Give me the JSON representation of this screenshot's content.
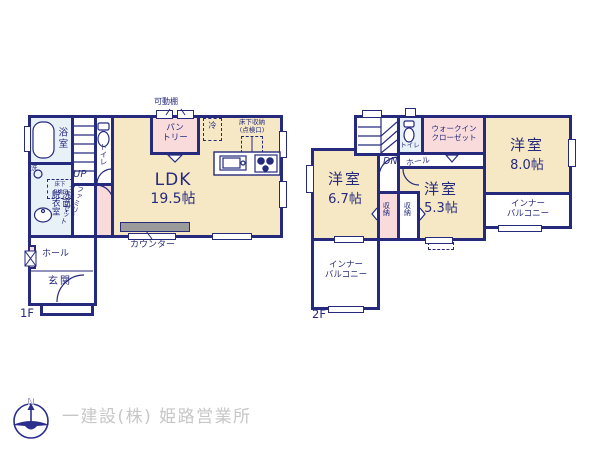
{
  "colors": {
    "wall_navy": "#252a7d",
    "room_cream": "#f6e8c4",
    "room_pink": "#f8dbda",
    "wet_area_blue": "#e9f1f8",
    "counter_gray": "#9b9b9b",
    "footer_text_gray": "#c7c7c7"
  },
  "floor1": {
    "label": "1F",
    "bath": "浴室",
    "washer": "洗",
    "underfloor_hatch": "床下\n点検口",
    "washroom": "洗面・\n脱衣室",
    "stairs": "UP",
    "toilet": "トイレ",
    "family_closet": "ファミリー\nクローゼット",
    "hall": "ホール",
    "entrance": "玄関",
    "ldk_name": "LDK",
    "ldk_size": "19.5帖",
    "pantry": "パン\nトリー",
    "movable_shelf": "可動棚",
    "fridge": "冷",
    "underfloor_storage": "床下収納\n(点検口)",
    "counter": "カウンター"
  },
  "floor2": {
    "label": "2F",
    "stairs": "DN",
    "toilet": "トイレ",
    "walkin_closet": "ウォークイン\nクローゼット",
    "hall": "ホール",
    "bedroom_a_name": "洋室",
    "bedroom_a_size": "8.0帖",
    "bedroom_b_name": "洋室",
    "bedroom_b_size": "6.7帖",
    "bedroom_c_name": "洋室",
    "bedroom_c_size": "5.3帖",
    "closet_left": "収納",
    "closet_right": "収納",
    "inner_balcony_right": "インナー\nバルコニー",
    "inner_balcony_left": "インナー\nバルコニー"
  },
  "footer": {
    "company": "一建設(株) 姫路営業所",
    "logo_letter": "N"
  }
}
